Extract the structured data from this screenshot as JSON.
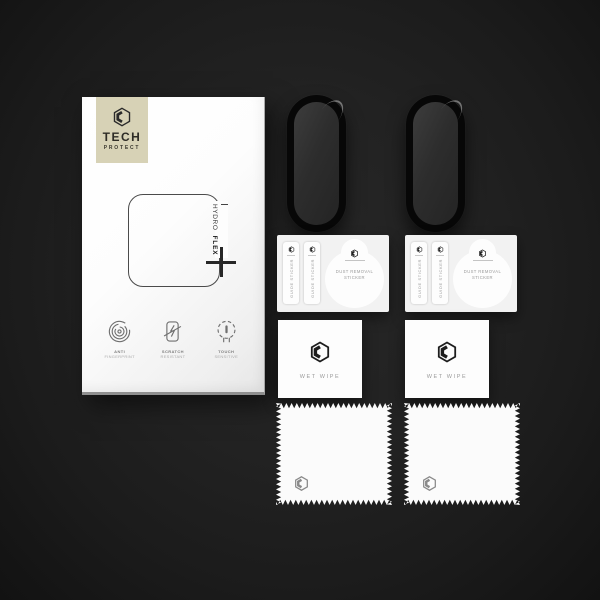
{
  "product": {
    "brand": {
      "name_line1": "TECH",
      "name_line2": "PROTECT"
    },
    "model": {
      "thin": "HYDRO",
      "bold": "FLEX"
    }
  },
  "box": {
    "features": [
      {
        "icon": "fingerprint-icon",
        "label_line1": "ANTI",
        "label_line2": "FINGERPRINT"
      },
      {
        "icon": "scratch-resistant-icon",
        "label_line1": "SCRATCH",
        "label_line2": "RESISTANT"
      },
      {
        "icon": "touch-sensitive-icon",
        "label_line1": "TOUCH",
        "label_line2": "SENSITIVE"
      }
    ]
  },
  "accessories": {
    "screen_protectors": {
      "count": 2,
      "shape": "oval-band-screen"
    },
    "sticker_cards": {
      "count": 2,
      "guide_sticker_label": "GUIDE STICKER",
      "dust_removal_line1": "DUST REMOVAL",
      "dust_removal_line2": "STICKER"
    },
    "wet_wipes": {
      "count": 2,
      "label": "WET WIPE"
    },
    "cleaning_cloths": {
      "count": 2
    }
  },
  "colors": {
    "background": "#1f1f1f",
    "brand_badge": "#d7d2b6",
    "box_white": "#fdfdfd",
    "protector_black": "#0a0a0a",
    "card_white": "#f2f2f2"
  }
}
